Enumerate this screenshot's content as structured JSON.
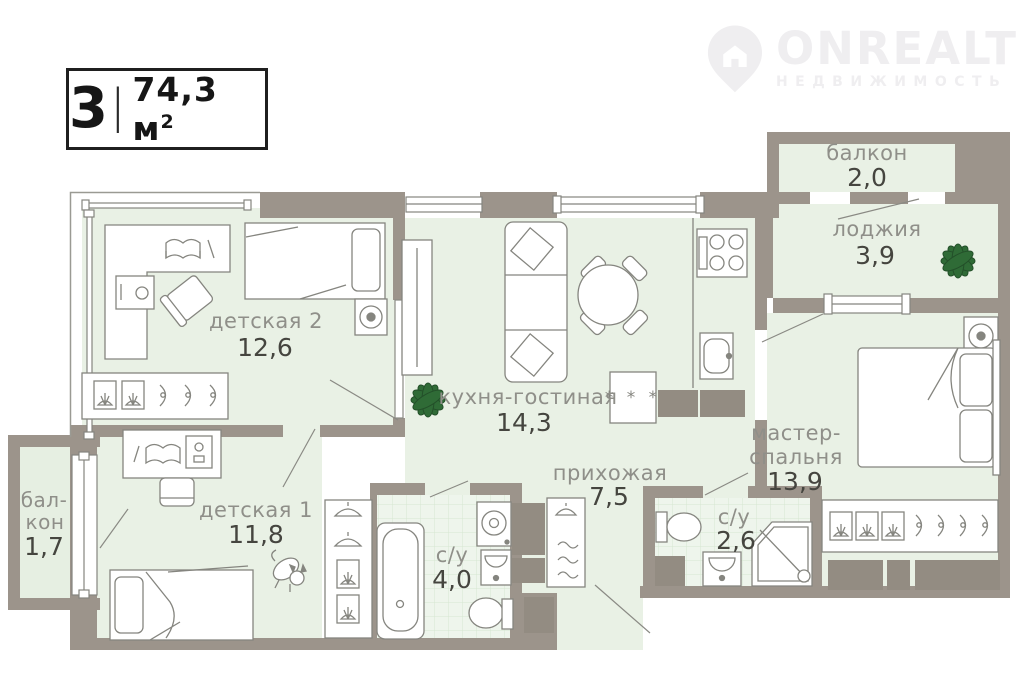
{
  "badge": {
    "rooms": "3",
    "divider": "|",
    "area": "74,3 м",
    "area_sup": "2"
  },
  "logo": {
    "brand": "ONREALT",
    "tagline": "НЕДВИЖИМОСТЬ"
  },
  "rooms": {
    "balcony_top": {
      "name": "балкон",
      "area": "2,0"
    },
    "loggia": {
      "name": "лоджия",
      "area": "3,9"
    },
    "kids2": {
      "name": "детская 2",
      "area": "12,6"
    },
    "kitchen_living": {
      "name": "кухня-гостиная",
      "area": "14,3"
    },
    "master_bedroom": {
      "name_line1": "мастер-",
      "name_line2": "спальня",
      "area": "13,9"
    },
    "hallway": {
      "name": "прихожая",
      "area": "7,5"
    },
    "kids1": {
      "name": "детская 1",
      "area": "11,8"
    },
    "balcony_left": {
      "name_line1": "бал-",
      "name_line2": "кон",
      "area": "1,7"
    },
    "bathroom_main": {
      "name": "с/у",
      "area": "4,0"
    },
    "bathroom_small": {
      "name": "с/у",
      "area": "2,6"
    }
  },
  "icons": {
    "washer_marks": "* * *"
  },
  "colors": {
    "wall": "#9c948b",
    "room_fill": "#e9f1e5",
    "tile_fill": "#eef5ec",
    "tile_line": "#d6e6d2",
    "furniture_line": "#85857f",
    "label_gray": "#8f8f89",
    "number_dark": "#45453f",
    "plant_green": "#2f6b36",
    "watermark": "#efeef0",
    "badge_border": "#1f1f1f"
  }
}
